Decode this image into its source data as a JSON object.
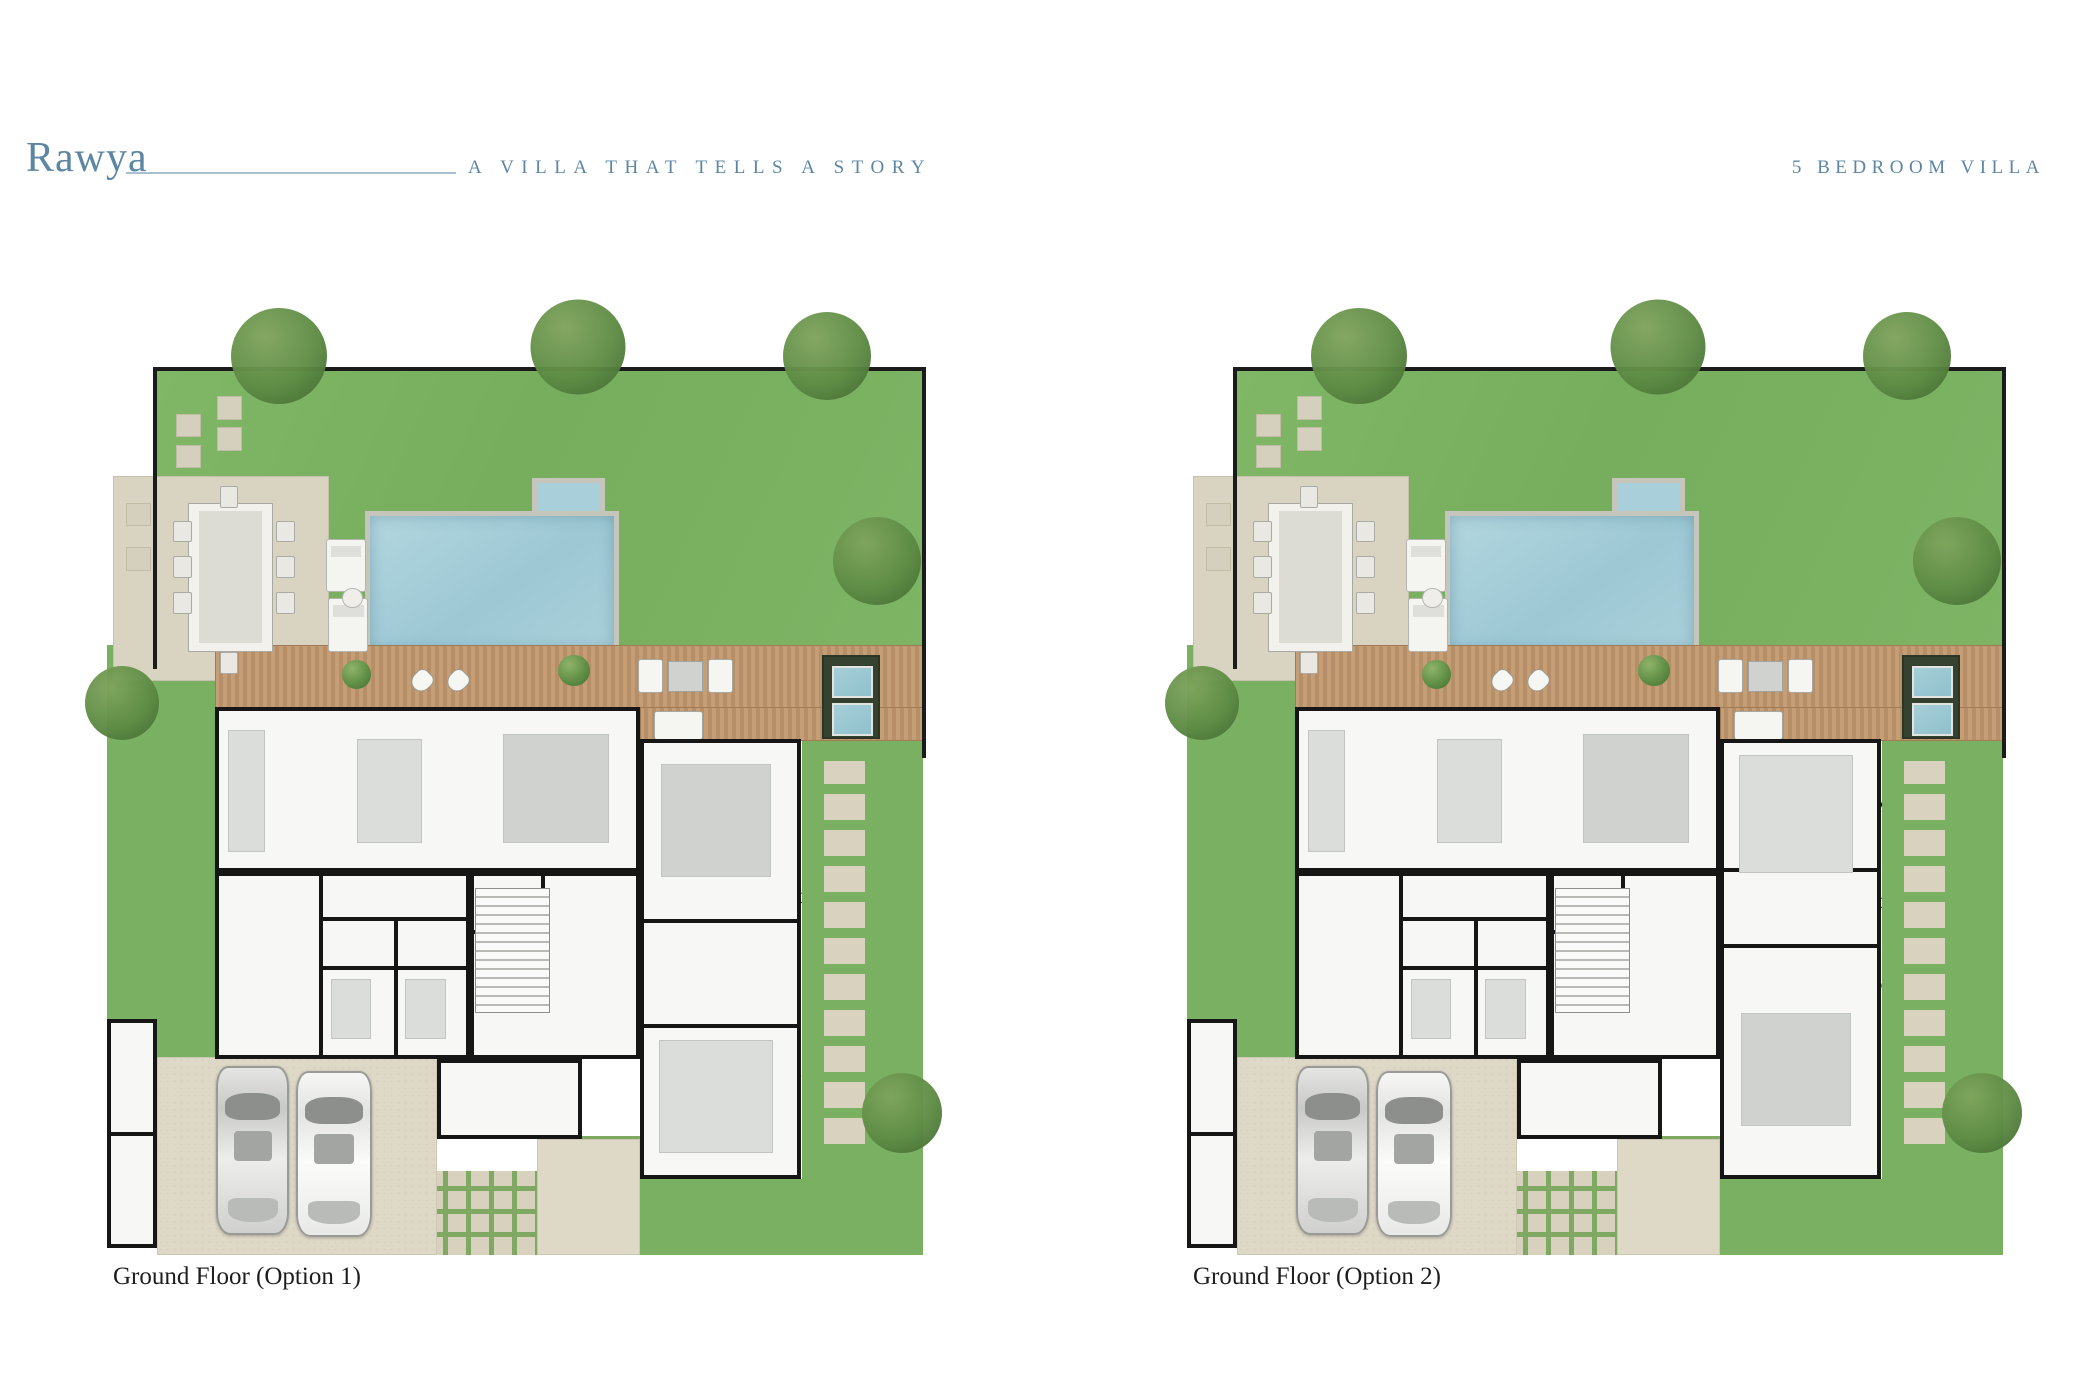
{
  "header": {
    "brand": "Rawya",
    "tagline": "A VILLA THAT TELLS A STORY",
    "badge": "5 BEDROOM VILLA",
    "accent_color": "#5d86a3"
  },
  "palette": {
    "lawn": "#7cb464",
    "pool_water": "#a9d0da",
    "deck_wood": "#bd9671",
    "paving": "#ded8c7",
    "wall": "#161616",
    "label_text": "#1a1a1a"
  },
  "plans": [
    {
      "caption": "Ground Floor (Option 1)",
      "variant": "option1",
      "rooms": [
        {
          "label": "KITCHEN",
          "dims": "4.3 x 4.9m",
          "x": 20.0,
          "y": 46.6
        },
        {
          "label": "DINING",
          "dims": "4.1 x 4.9m",
          "x": 34.3,
          "y": 46.6
        },
        {
          "label": "LIVING",
          "dims": "5.5 x 4.9m",
          "x": 51.2,
          "y": 46.6
        },
        {
          "label": "LIVING ROOM",
          "dims": "4.4 x 6.3m",
          "x": 73.6,
          "y": 59.0
        },
        {
          "label": "LAUNDRY",
          "x": 37.1,
          "y": 59.3
        },
        {
          "label": "POWDER\nROOM",
          "x": 48.0,
          "y": 59.6
        },
        {
          "label": "MAID'S\nBATHROOM",
          "x": 30.5,
          "y": 64.3
        },
        {
          "label": "DRIVER'S\nBATHROOM",
          "x": 37.9,
          "y": 64.3
        },
        {
          "label": "HEAVY\nKITCHEN",
          "x": 18.2,
          "y": 70.3
        },
        {
          "label": "MAID'S\nROOM",
          "x": 28.4,
          "y": 70.0
        },
        {
          "label": "DRIVER'S\nROOM",
          "x": 37.8,
          "y": 71.4
        },
        {
          "label": "FOYER",
          "x": 55.2,
          "y": 68.3
        },
        {
          "label": "BATHROOM",
          "x": 67.8,
          "y": 70.0
        },
        {
          "label": "BEDROOM",
          "dims": "4.5 x 4.0m",
          "x": 73.3,
          "y": 78.8
        },
        {
          "label": "STORE",
          "x": 50.2,
          "y": 79.9
        },
        {
          "label": "UTILITIES",
          "x": 3.2,
          "y": 79.5,
          "vertical": true
        },
        {
          "label": "UTILITIES",
          "x": 3.2,
          "y": 91.0,
          "vertical": true
        }
      ]
    },
    {
      "caption": "Ground Floor (Option 2)",
      "variant": "option2",
      "rooms": [
        {
          "label": "KITCHEN",
          "dims": "4.3 x 4.9m",
          "x": 20.5,
          "y": 46.6
        },
        {
          "label": "DINING",
          "dims": "4.1 x 4.9m",
          "x": 35.0,
          "y": 46.6
        },
        {
          "label": "LIVING",
          "dims": "5.5 x 4.9m",
          "x": 52.0,
          "y": 46.6
        },
        {
          "label": "BEDROOM",
          "dims": "4.5 x 4.0M",
          "x": 75.5,
          "y": 48.8
        },
        {
          "label": "BATHROOM",
          "x": 75.3,
          "y": 59.6
        },
        {
          "label": "LAUNDRY",
          "x": 37.1,
          "y": 58.9
        },
        {
          "label": "POWDER\nROOM",
          "x": 48.5,
          "y": 59.3
        },
        {
          "label": "MAID'S\nBATHROOM",
          "x": 32.3,
          "y": 64.6
        },
        {
          "label": "DRIVER'S\nBATHROOM",
          "x": 40.3,
          "y": 63.4
        },
        {
          "label": "HEAVY\nKITCHEN",
          "x": 18.9,
          "y": 70.5
        },
        {
          "label": "MAID'S\nROOM",
          "x": 29.2,
          "y": 70.1
        },
        {
          "label": "DRIVER'S\nROOM",
          "x": 38.9,
          "y": 71.4
        },
        {
          "label": "FOYER",
          "x": 59.7,
          "y": 67.7
        },
        {
          "label": "LIVING ROOM",
          "dims": "4.4 x 6.3M",
          "x": 74.2,
          "y": 68.9
        },
        {
          "label": "STORE",
          "x": 50.4,
          "y": 79.6
        },
        {
          "label": "UTILITIES",
          "x": 3.2,
          "y": 79.5,
          "vertical": true
        },
        {
          "label": "UTILITIES",
          "x": 3.2,
          "y": 91.0,
          "vertical": true
        }
      ]
    }
  ]
}
